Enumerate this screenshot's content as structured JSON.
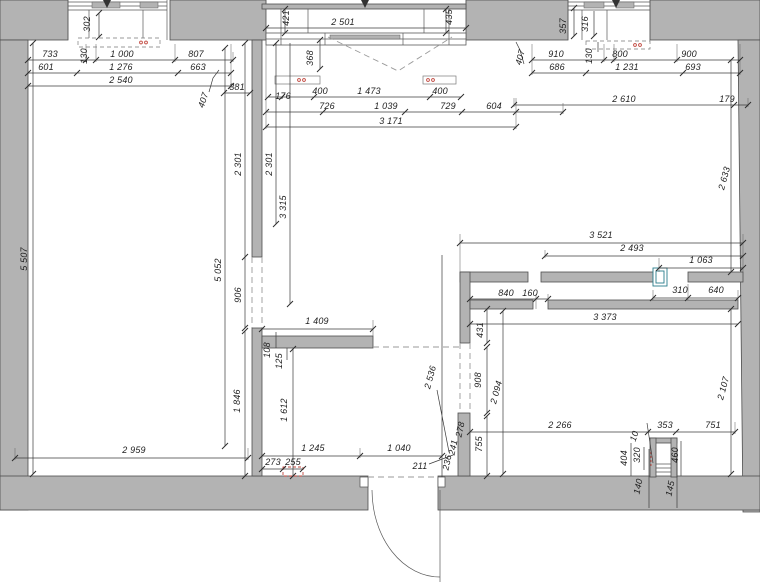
{
  "drawing": {
    "kind": "architectural floor plan",
    "colors": {
      "wall_fill": "#b3b3b3",
      "wall_stroke": "#4e4e4e",
      "dim_color": "#3c3c3c",
      "dash_color": "#9a9a9a",
      "accent_red": "#c0453c",
      "accent_teal": "#2a7d8c",
      "background": "#ffffff"
    },
    "dimension_labels": [
      {
        "text": "302",
        "x": 90,
        "y": 24,
        "rot": -90
      },
      {
        "text": "733",
        "x": 50,
        "y": 57,
        "rot": 0
      },
      {
        "text": "130",
        "x": 87,
        "y": 56,
        "rot": -90
      },
      {
        "text": "1 000",
        "x": 122,
        "y": 57,
        "rot": 0
      },
      {
        "text": "807",
        "x": 196,
        "y": 57,
        "rot": 0
      },
      {
        "text": "601",
        "x": 46,
        "y": 70,
        "rot": 0
      },
      {
        "text": "1 276",
        "x": 121,
        "y": 70,
        "rot": 0
      },
      {
        "text": "663",
        "x": 198,
        "y": 70,
        "rot": 0
      },
      {
        "text": "2 540",
        "x": 121,
        "y": 83,
        "rot": 0
      },
      {
        "text": "407",
        "x": 206,
        "y": 101,
        "rot": -72
      },
      {
        "text": "381",
        "x": 237,
        "y": 90,
        "rot": 0
      },
      {
        "text": "421",
        "x": 289,
        "y": 18,
        "rot": -90
      },
      {
        "text": "2 501",
        "x": 343,
        "y": 25,
        "rot": 0
      },
      {
        "text": "435",
        "x": 452,
        "y": 17,
        "rot": -90
      },
      {
        "text": "368",
        "x": 313,
        "y": 58,
        "rot": -90
      },
      {
        "text": "176",
        "x": 283,
        "y": 99,
        "rot": 0
      },
      {
        "text": "400",
        "x": 320,
        "y": 94,
        "rot": 0
      },
      {
        "text": "1 473",
        "x": 369,
        "y": 94,
        "rot": 0
      },
      {
        "text": "400",
        "x": 440,
        "y": 94,
        "rot": 0
      },
      {
        "text": "726",
        "x": 327,
        "y": 109,
        "rot": 0
      },
      {
        "text": "1 039",
        "x": 386,
        "y": 109,
        "rot": 0
      },
      {
        "text": "729",
        "x": 448,
        "y": 109,
        "rot": 0
      },
      {
        "text": "604",
        "x": 494,
        "y": 109,
        "rot": 0
      },
      {
        "text": "3 171",
        "x": 391,
        "y": 124,
        "rot": 0
      },
      {
        "text": "357",
        "x": 566,
        "y": 26,
        "rot": -90
      },
      {
        "text": "316",
        "x": 588,
        "y": 24,
        "rot": -90
      },
      {
        "text": "407",
        "x": 523,
        "y": 58,
        "rot": -75
      },
      {
        "text": "910",
        "x": 556,
        "y": 57,
        "rot": 0
      },
      {
        "text": "130",
        "x": 592,
        "y": 56,
        "rot": -90
      },
      {
        "text": "800",
        "x": 620,
        "y": 57,
        "rot": 0
      },
      {
        "text": "900",
        "x": 689,
        "y": 57,
        "rot": 0
      },
      {
        "text": "686",
        "x": 557,
        "y": 70,
        "rot": 0
      },
      {
        "text": "1 231",
        "x": 627,
        "y": 70,
        "rot": 0
      },
      {
        "text": "693",
        "x": 693,
        "y": 70,
        "rot": 0
      },
      {
        "text": "2 610",
        "x": 624,
        "y": 102,
        "rot": 0
      },
      {
        "text": "179",
        "x": 727,
        "y": 102,
        "rot": 0
      },
      {
        "text": "5 507",
        "x": 27,
        "y": 259,
        "rot": -90
      },
      {
        "text": "2 301",
        "x": 241,
        "y": 164,
        "rot": -90
      },
      {
        "text": "2 301",
        "x": 272,
        "y": 164,
        "rot": -90
      },
      {
        "text": "3 315",
        "x": 286,
        "y": 207,
        "rot": -90
      },
      {
        "text": "2 633",
        "x": 727,
        "y": 179,
        "rot": -75
      },
      {
        "text": "5 052",
        "x": 221,
        "y": 270,
        "rot": -90
      },
      {
        "text": "906",
        "x": 241,
        "y": 295,
        "rot": -90
      },
      {
        "text": "3 521",
        "x": 601,
        "y": 238,
        "rot": 0
      },
      {
        "text": "2 493",
        "x": 632,
        "y": 251,
        "rot": 0
      },
      {
        "text": "1 063",
        "x": 701,
        "y": 263,
        "rot": 0
      },
      {
        "text": "310",
        "x": 680,
        "y": 293,
        "rot": 0
      },
      {
        "text": "640",
        "x": 716,
        "y": 293,
        "rot": 0
      },
      {
        "text": "840",
        "x": 506,
        "y": 296,
        "rot": 0
      },
      {
        "text": "160",
        "x": 530,
        "y": 296,
        "rot": 0
      },
      {
        "text": "3 373",
        "x": 605,
        "y": 320,
        "rot": 0
      },
      {
        "text": "431",
        "x": 483,
        "y": 330,
        "rot": -90
      },
      {
        "text": "1 409",
        "x": 317,
        "y": 324,
        "rot": 0
      },
      {
        "text": "108",
        "x": 270,
        "y": 350,
        "rot": -90
      },
      {
        "text": "125",
        "x": 282,
        "y": 361,
        "rot": -90
      },
      {
        "text": "2 536",
        "x": 433,
        "y": 378,
        "rot": -75
      },
      {
        "text": "908",
        "x": 481,
        "y": 380,
        "rot": -90
      },
      {
        "text": "2 094",
        "x": 499,
        "y": 393,
        "rot": -75
      },
      {
        "text": "2 107",
        "x": 726,
        "y": 389,
        "rot": -75
      },
      {
        "text": "1 846",
        "x": 240,
        "y": 401,
        "rot": -90
      },
      {
        "text": "1 612",
        "x": 287,
        "y": 410,
        "rot": -90
      },
      {
        "text": "755",
        "x": 482,
        "y": 444,
        "rot": -90
      },
      {
        "text": "2 959",
        "x": 134,
        "y": 453,
        "rot": 0
      },
      {
        "text": "1 245",
        "x": 313,
        "y": 451,
        "rot": 0
      },
      {
        "text": "1 040",
        "x": 399,
        "y": 451,
        "rot": 0
      },
      {
        "text": "273",
        "x": 273,
        "y": 465,
        "rot": 0
      },
      {
        "text": "255",
        "x": 293,
        "y": 465,
        "rot": 0
      },
      {
        "text": "211",
        "x": 420,
        "y": 469,
        "rot": 0
      },
      {
        "text": "236",
        "x": 450,
        "y": 463,
        "rot": -78
      },
      {
        "text": "241",
        "x": 456,
        "y": 448,
        "rot": -78
      },
      {
        "text": "278",
        "x": 463,
        "y": 430,
        "rot": -78
      },
      {
        "text": "2 266",
        "x": 560,
        "y": 428,
        "rot": 0
      },
      {
        "text": "353",
        "x": 665,
        "y": 428,
        "rot": 0
      },
      {
        "text": "751",
        "x": 713,
        "y": 428,
        "rot": 0
      },
      {
        "text": "10",
        "x": 637,
        "y": 437,
        "rot": -72
      },
      {
        "text": "404",
        "x": 627,
        "y": 458,
        "rot": -90
      },
      {
        "text": "320",
        "x": 640,
        "y": 455,
        "rot": -90
      },
      {
        "text": "460",
        "x": 678,
        "y": 455,
        "rot": -90
      },
      {
        "text": "140",
        "x": 641,
        "y": 487,
        "rot": -78
      },
      {
        "text": "145",
        "x": 673,
        "y": 489,
        "rot": -78
      }
    ]
  }
}
